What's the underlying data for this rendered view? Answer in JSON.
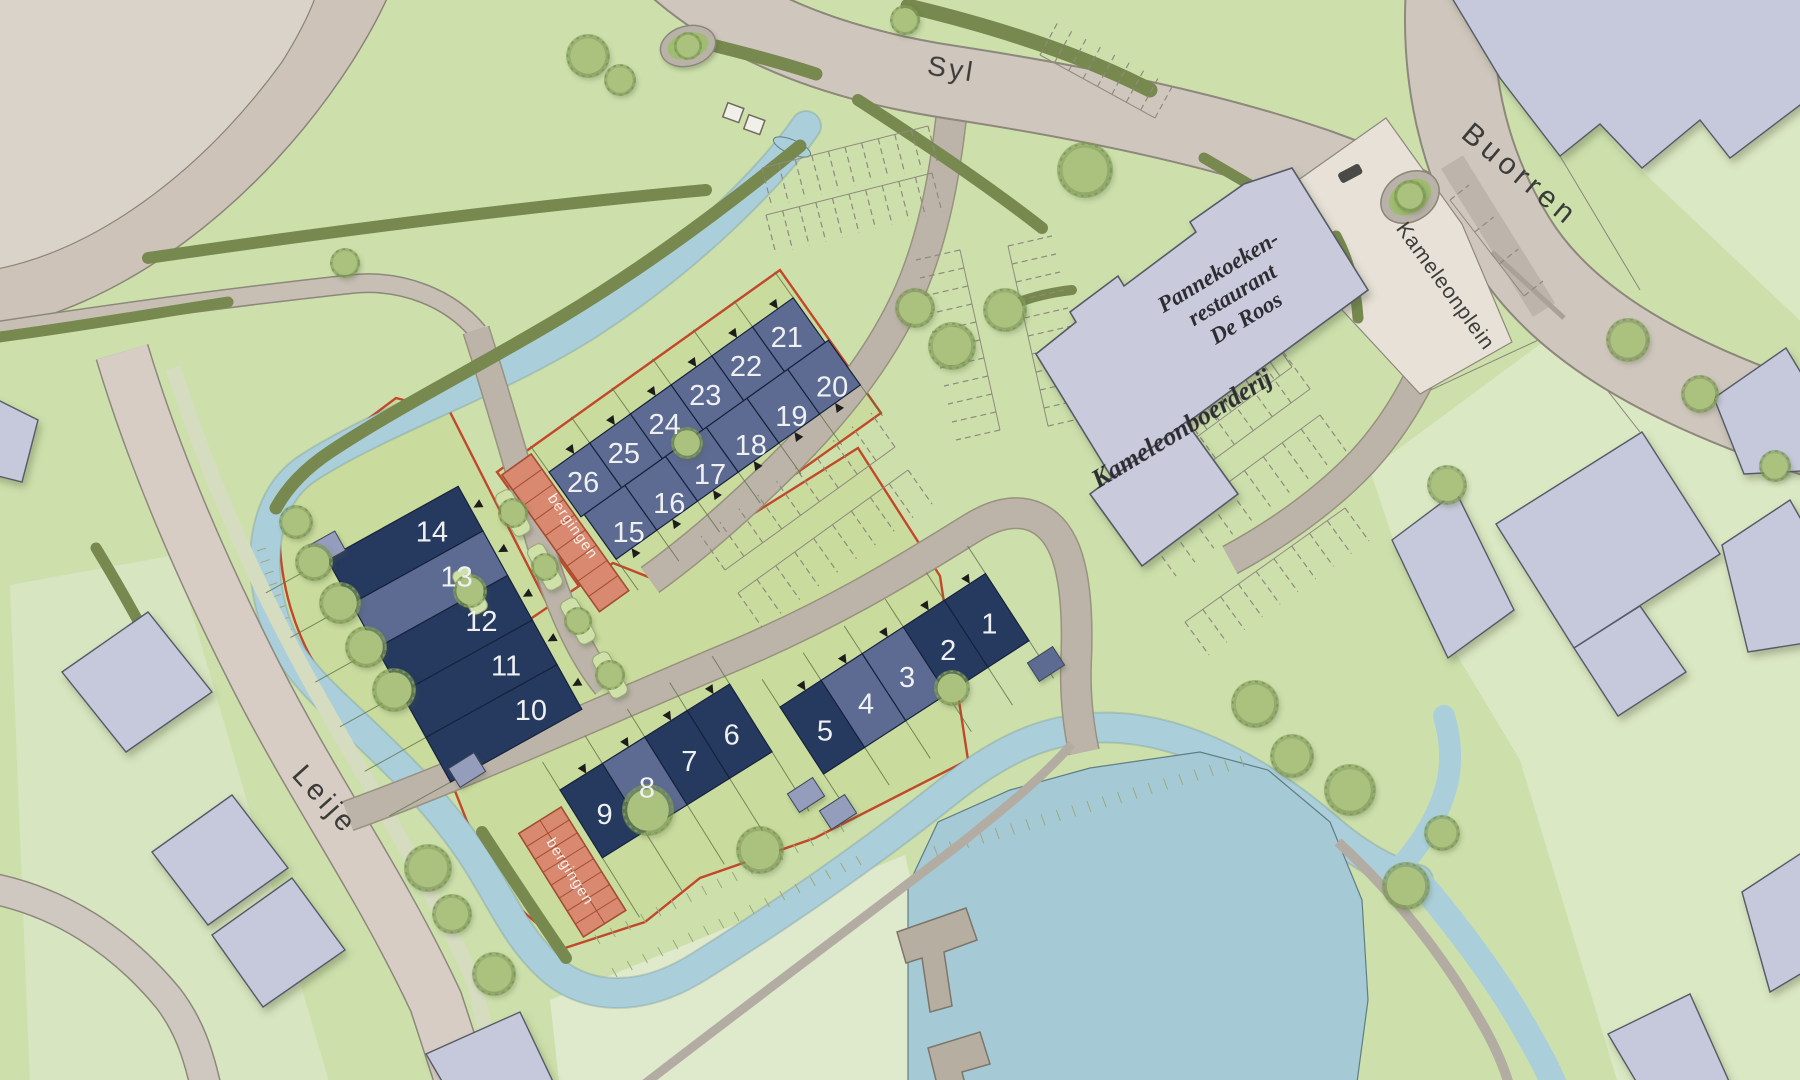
{
  "map": {
    "streets": [
      {
        "id": "syl",
        "label": "Syl",
        "x": 950,
        "y": 78,
        "rot": 9,
        "size": 28,
        "ls": 3
      },
      {
        "id": "buorren",
        "label": "Buorren",
        "x": 1514,
        "y": 182,
        "rot": 40,
        "size": 30,
        "ls": 5
      },
      {
        "id": "kameleonplein",
        "label": "Kameleonplein",
        "x": 1440,
        "y": 290,
        "rot": 54,
        "size": 21,
        "ls": 1
      },
      {
        "id": "leije",
        "label": "Leije",
        "x": 318,
        "y": 806,
        "rot": 48,
        "size": 29,
        "ls": 4
      }
    ],
    "building_labels": [
      {
        "id": "restaurant",
        "lines": [
          "Pannekoeken-",
          "restaurant",
          "De Roos"
        ],
        "x": 1222,
        "y": 278,
        "rot": -31,
        "size": 23,
        "lh": 27
      },
      {
        "id": "farm",
        "lines": [
          "Kameleonboerderij"
        ],
        "x": 1186,
        "y": 436,
        "rot": -31,
        "size": 26,
        "lh": 28
      }
    ],
    "bergingen": [
      {
        "label": "bergingen",
        "block": 1,
        "x": -40,
        "y": -25,
        "w": 36,
        "h": 168,
        "cells": 9,
        "lx": 569,
        "ly": 529,
        "lrot": 55
      },
      {
        "label": "bergingen",
        "block": 2,
        "x": -58,
        "y": 15,
        "w": 50,
        "h": 122,
        "cells": 8,
        "lx": 566,
        "ly": 874,
        "lrot": 58
      }
    ],
    "lot_blocks": [
      {
        "id": "block-west",
        "tx": 327,
        "ty": 559,
        "rot": -29,
        "type": "stackY",
        "unitLen": 150,
        "unitDepth": 51,
        "numOff": [
          105,
          27
        ],
        "gardenLen": 70,
        "units": [
          14,
          13,
          12,
          11,
          10
        ],
        "tones": [
          "dark",
          "mid",
          "dark",
          "dark",
          "dark"
        ]
      },
      {
        "id": "block-mid",
        "tx": 549,
        "ty": 472,
        "rot": -35.5,
        "type": "rows",
        "unitW": 50,
        "rowH": 55,
        "gTop": -32,
        "gBot": 148,
        "arrowsTop": true,
        "arrowsBottom": true,
        "rows": [
          {
            "y": 0,
            "off": 0,
            "numOff": [
              22,
              28
            ],
            "units": [
              26,
              25,
              24,
              23,
              22,
              21
            ],
            "tones": [
              "mid",
              "mid",
              "mid",
              "mid",
              "mid",
              "mid"
            ]
          },
          {
            "y": 55,
            "off": 4,
            "numOff": [
              26,
              40
            ],
            "units": [
              15,
              16,
              17,
              18,
              19,
              20
            ],
            "tones": [
              "mid",
              "mid",
              "mid",
              "mid",
              "mid",
              "mid"
            ]
          }
        ]
      },
      {
        "id": "block-south-west",
        "tx": 560,
        "ty": 790,
        "rot": -32,
        "type": "rows",
        "unitW": 50,
        "rowH": 80,
        "gTop": -33,
        "gBot": 150,
        "arrowsTop": true,
        "arrowsBottom": false,
        "rows": [
          {
            "y": 0,
            "off": 0,
            "numOff": [
              25,
              44
            ],
            "units": [
              9,
              8,
              7,
              6
            ],
            "tones": [
              "dark",
              "mid",
              "dark",
              "dark"
            ]
          }
        ]
      },
      {
        "id": "block-south-east",
        "tx": 780,
        "ty": 707,
        "rot": -33,
        "type": "rows",
        "unitW": 49,
        "rowH": 80,
        "gTop": -33,
        "gBot": 125,
        "arrowsTop": true,
        "arrowsBottom": false,
        "rows": [
          {
            "y": 0,
            "off": 0,
            "numOff": [
              25,
              44
            ],
            "units": [
              5,
              4,
              3,
              2,
              1
            ],
            "tones": [
              "dark",
              "mid",
              "mid",
              "dark",
              "dark"
            ]
          }
        ]
      }
    ],
    "colors": {
      "base": "#cde0ac",
      "pale": "#dbe8c4",
      "parcel": "#c9dc9e",
      "water": "#abcfda",
      "pond": "#a6cad5",
      "roadMain": "#cfc7bd",
      "roadLeije": "#d8cdc5",
      "roadMinor": "#bcb4a9",
      "path": "#c7bfb4",
      "plaza": "#e7e1d7",
      "parking": "#cac2b8",
      "fieldInner": "#dad3c9",
      "fieldRing": "#cdc3b8",
      "hedge": "#77894f",
      "treeFill": "#abc17e",
      "treeEdge": "#7f9a55",
      "houseDark": "#263a60",
      "houseMid": "#5d6b92",
      "houseStroke": "#16223c",
      "shed": "#959dbc",
      "berging": "#d9896f",
      "bergingLine": "#a34d31",
      "red": "#c2482a",
      "line": "#6f6a5c",
      "gardenLine": "#5f7247",
      "text": "#3b3b39",
      "num": "#eef0f2",
      "script": "#2d2d33",
      "white": "#f5f3ec"
    }
  }
}
